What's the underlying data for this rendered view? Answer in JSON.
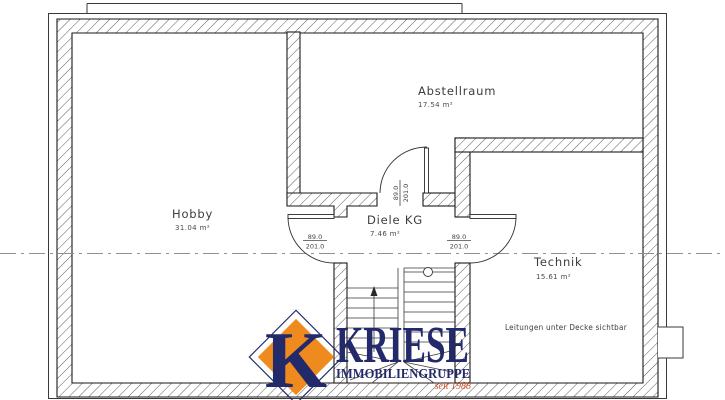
{
  "plan": {
    "rooms": [
      {
        "id": "abstellraum",
        "name": "Abstellraum",
        "area": "17.54 m²"
      },
      {
        "id": "hobby",
        "name": "Hobby",
        "area": "31.04 m²"
      },
      {
        "id": "diele",
        "name": "Diele KG",
        "area": "7.46 m²"
      },
      {
        "id": "technik",
        "name": "Technik",
        "area": "15.61 m²"
      }
    ],
    "note": "Leitungen unter Decke sichtbar",
    "door_size": {
      "width": "89.0",
      "height": "201.0"
    }
  },
  "logo": {
    "mark_letter": "K",
    "name": "KRIESE",
    "subtitle": "IMMOBILIENGRUPPE",
    "since": "seit 1988"
  },
  "colors": {
    "navy": "#232a6c",
    "orange": "#ef8a1e",
    "since_red": "#cf4f1f",
    "line": "#1a1a1a"
  }
}
